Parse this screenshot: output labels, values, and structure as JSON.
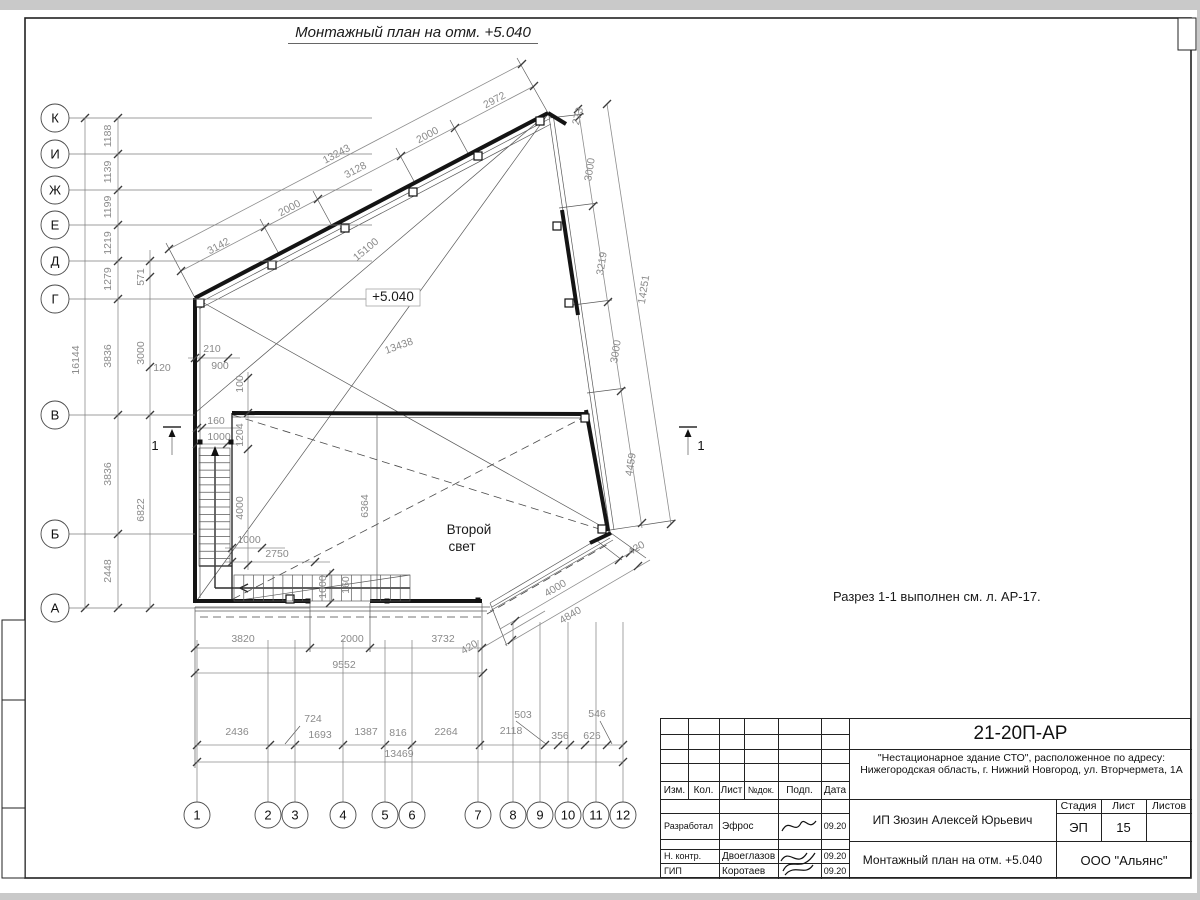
{
  "title": "Монтажный план на отм. +5.040",
  "note": "Разрез 1-1 выполнен см. л. АР-17.",
  "second_light": {
    "line1": "Второй",
    "line2": "свет"
  },
  "elevation_mark": "+5.040",
  "stamp": {
    "code": "21-20П-АР",
    "address1": "\"Нестационарное здание СТО\", расположенное по адресу:",
    "address2": "Нижегородская область, г. Нижний Новгород, ул. Вторчермета, 1А",
    "client": "ИП Зюзин Алексей Юрьевич",
    "doc_title": "Монтажный план на отм. +5.040",
    "org": "ООО \"Альянс\"",
    "cols": [
      "Изм.",
      "Кол.",
      "Лист",
      "№док.",
      "Подп.",
      "Дата"
    ],
    "stage_label": "Стадия",
    "sheet_label": "Лист",
    "sheets_label": "Листов",
    "stage": "ЭП",
    "sheet_num": "15",
    "rows": [
      {
        "role": "Разработал",
        "name": "Эфрос",
        "date": "09.20"
      },
      {
        "role": "Н. контр.",
        "name": "Двоеглазов",
        "date": "09.20"
      },
      {
        "role": "ГИП",
        "name": "Коротаев",
        "date": "09.20"
      }
    ]
  },
  "drawing": {
    "axis_left": {
      "cx": 55,
      "r": 14,
      "items": [
        {
          "label": "К",
          "y": 118,
          "x2": 372
        },
        {
          "label": "И",
          "y": 154,
          "x2": 372
        },
        {
          "label": "Ж",
          "y": 190,
          "x2": 372
        },
        {
          "label": "Е",
          "y": 225,
          "x2": 372
        },
        {
          "label": "Д",
          "y": 261,
          "x2": 372
        },
        {
          "label": "Г",
          "y": 299,
          "x2": 372
        },
        {
          "label": "В",
          "y": 415,
          "x2": 195
        },
        {
          "label": "Б",
          "y": 534,
          "x2": 195
        },
        {
          "label": "А",
          "y": 608,
          "x2": 310
        }
      ]
    },
    "axis_bottom": {
      "cy": 815,
      "r": 13,
      "items": [
        {
          "label": "1",
          "x": 197,
          "ly": 640
        },
        {
          "label": "2",
          "x": 268,
          "ly": 640
        },
        {
          "label": "3",
          "x": 295,
          "ly": 640
        },
        {
          "label": "4",
          "x": 343,
          "ly": 640
        },
        {
          "label": "5",
          "x": 385,
          "ly": 640
        },
        {
          "label": "6",
          "x": 412,
          "ly": 640
        },
        {
          "label": "7",
          "x": 478,
          "ly": 640
        },
        {
          "label": "8",
          "x": 513,
          "ly": 622
        },
        {
          "label": "9",
          "x": 540,
          "ly": 622
        },
        {
          "label": "10",
          "x": 568,
          "ly": 622
        },
        {
          "label": "11",
          "x": 596,
          "ly": 622
        },
        {
          "label": "12",
          "x": 623,
          "ly": 622
        }
      ]
    },
    "wall_lines": [
      [
        195,
        298,
        548,
        113
      ],
      [
        195,
        298,
        195,
        603
      ],
      [
        232,
        413,
        588,
        414
      ],
      [
        195,
        601,
        310,
        601
      ],
      [
        370,
        601,
        482,
        601
      ],
      [
        562,
        210,
        578,
        315
      ],
      [
        586,
        410,
        608,
        531
      ],
      [
        590,
        543,
        611,
        533
      ],
      [
        548,
        113,
        566,
        124
      ]
    ],
    "med_lines": [
      [
        232,
        413,
        232,
        600
      ],
      [
        199,
        566,
        232,
        566
      ],
      [
        215,
        588,
        215,
        452
      ],
      [
        410,
        588,
        215,
        588
      ],
      [
        248,
        584,
        240,
        588
      ],
      [
        240,
        588,
        248,
        592
      ]
    ],
    "thin_lines": [
      [
        197,
        304,
        549,
        119
      ],
      [
        199,
        309,
        551,
        124
      ],
      [
        549,
        116,
        610,
        532
      ],
      [
        553,
        114,
        614,
        530
      ],
      [
        608,
        533,
        490,
        603
      ],
      [
        610,
        538,
        492,
        607
      ],
      [
        195,
        607,
        490,
        607
      ],
      [
        195,
        611,
        487,
        611
      ],
      [
        490,
        611,
        613,
        540
      ],
      [
        232,
        417,
        588,
        418
      ],
      [
        200,
        303,
        200,
        598
      ],
      [
        195,
        603,
        548,
        114
      ],
      [
        195,
        413,
        548,
        113
      ],
      [
        195,
        298,
        610,
        531
      ],
      [
        377,
        413,
        377,
        601
      ],
      [
        234,
        601,
        410,
        575
      ],
      [
        195,
        298,
        166,
        243
      ],
      [
        279,
        254,
        260,
        219
      ],
      [
        332,
        226,
        313,
        191
      ],
      [
        415,
        183,
        396,
        148
      ],
      [
        469,
        155,
        450,
        120
      ],
      [
        548,
        113,
        517,
        58
      ],
      [
        549,
        118,
        584,
        114
      ],
      [
        559,
        208,
        598,
        203
      ],
      [
        573,
        305,
        612,
        300
      ],
      [
        587,
        393,
        626,
        388
      ],
      [
        610,
        530,
        676,
        520
      ],
      [
        608,
        531,
        646,
        558
      ],
      [
        490,
        603,
        507,
        646
      ],
      [
        596,
        540,
        622,
        560
      ],
      [
        195,
        607,
        195,
        768
      ],
      [
        310,
        603,
        310,
        652
      ],
      [
        370,
        603,
        370,
        652
      ],
      [
        482,
        603,
        482,
        750
      ],
      [
        516,
        721,
        546,
        744
      ],
      [
        600,
        721,
        612,
        744
      ],
      [
        300,
        726,
        285,
        744
      ]
    ],
    "dash_lines": [
      [
        233,
        415,
        606,
        531
      ],
      [
        233,
        599,
        588,
        415
      ],
      [
        200,
        617,
        482,
        617
      ],
      [
        487,
        614,
        610,
        543
      ]
    ],
    "dim_lines": [
      [
        85,
        118,
        85,
        608
      ],
      [
        118,
        118,
        118,
        608
      ],
      [
        150,
        250,
        150,
        608
      ],
      [
        188,
        358,
        240,
        358
      ],
      [
        197,
        428,
        240,
        428
      ],
      [
        197,
        444,
        240,
        444
      ],
      [
        225,
        548,
        285,
        548
      ],
      [
        225,
        562,
        330,
        562
      ],
      [
        248,
        372,
        248,
        570
      ],
      [
        330,
        570,
        330,
        604
      ],
      [
        181,
        271,
        534,
        86
      ],
      [
        169,
        249,
        522,
        64
      ],
      [
        578,
        108,
        642,
        528
      ],
      [
        607,
        104,
        671,
        524
      ],
      [
        640,
        547,
        500,
        629
      ],
      [
        650,
        560,
        505,
        645
      ],
      [
        195,
        648,
        482,
        648
      ],
      [
        482,
        648,
        545,
        611
      ],
      [
        195,
        673,
        483,
        673
      ],
      [
        197,
        745,
        623,
        745
      ],
      [
        197,
        762,
        623,
        762
      ]
    ],
    "ticks": [
      [
        85,
        118
      ],
      [
        85,
        608
      ],
      [
        118,
        118
      ],
      [
        118,
        154
      ],
      [
        118,
        190
      ],
      [
        118,
        225
      ],
      [
        118,
        261
      ],
      [
        118,
        299
      ],
      [
        118,
        415
      ],
      [
        118,
        534
      ],
      [
        118,
        608
      ],
      [
        150,
        261
      ],
      [
        150,
        277
      ],
      [
        150,
        367
      ],
      [
        150,
        415
      ],
      [
        150,
        608
      ],
      [
        195,
        358
      ],
      [
        201,
        358
      ],
      [
        228,
        358
      ],
      [
        197,
        428
      ],
      [
        202,
        428
      ],
      [
        197,
        444
      ],
      [
        227,
        444
      ],
      [
        232,
        548
      ],
      [
        262,
        548
      ],
      [
        232,
        562
      ],
      [
        315,
        562
      ],
      [
        248,
        378
      ],
      [
        248,
        413
      ],
      [
        248,
        449
      ],
      [
        248,
        565
      ],
      [
        330,
        573
      ],
      [
        330,
        603
      ],
      [
        181,
        271
      ],
      [
        265,
        227
      ],
      [
        318,
        199
      ],
      [
        401,
        156
      ],
      [
        455,
        128
      ],
      [
        534,
        86
      ],
      [
        169,
        249
      ],
      [
        522,
        64
      ],
      [
        578,
        109
      ],
      [
        579,
        117
      ],
      [
        593,
        206
      ],
      [
        608,
        302
      ],
      [
        621,
        391
      ],
      [
        642,
        523
      ],
      [
        607,
        104
      ],
      [
        671,
        524
      ],
      [
        630,
        553
      ],
      [
        619,
        560
      ],
      [
        515,
        621
      ],
      [
        638,
        566
      ],
      [
        512,
        640
      ],
      [
        195,
        648
      ],
      [
        310,
        648
      ],
      [
        370,
        648
      ],
      [
        482,
        648
      ],
      [
        195,
        673
      ],
      [
        483,
        673
      ],
      [
        197,
        745
      ],
      [
        270,
        745
      ],
      [
        295,
        745
      ],
      [
        343,
        745
      ],
      [
        385,
        745
      ],
      [
        412,
        745
      ],
      [
        480,
        745
      ],
      [
        545,
        745
      ],
      [
        558,
        745
      ],
      [
        570,
        745
      ],
      [
        585,
        745
      ],
      [
        607,
        745
      ],
      [
        623,
        745
      ],
      [
        197,
        762
      ],
      [
        623,
        762
      ]
    ],
    "squares": [
      [
        200,
        303
      ],
      [
        272,
        265
      ],
      [
        345,
        228
      ],
      [
        413,
        192
      ],
      [
        478,
        156
      ],
      [
        540,
        121
      ],
      [
        557,
        226
      ],
      [
        569,
        303
      ],
      [
        585,
        418
      ],
      [
        602,
        529
      ],
      [
        290,
        599
      ]
    ],
    "dots": [
      [
        308,
        601
      ],
      [
        387,
        601
      ],
      [
        478,
        600
      ],
      [
        200,
        442
      ],
      [
        231,
        442
      ]
    ],
    "steps": [
      {
        "x": 199,
        "y": 448,
        "w": 31,
        "h": 118,
        "n": 16,
        "dir": "h"
      },
      {
        "x": 234,
        "y": 575,
        "w": 176,
        "h": 26,
        "n": 18,
        "dir": "v"
      }
    ],
    "walk_arrow": {
      "x": 215,
      "y": 452
    },
    "elev_box": {
      "x": 366,
      "y": 289,
      "w": 54,
      "h": 17,
      "tx": 393,
      "ty": 301
    },
    "section_marks": [
      {
        "num": "1",
        "bx1": 163,
        "bx2": 181,
        "by": 427,
        "sx": 172,
        "sy1": 455,
        "sy2": 431,
        "tx": 155,
        "ty": 450
      },
      {
        "num": "1",
        "bx1": 679,
        "bx2": 697,
        "by": 427,
        "sx": 688,
        "sy1": 455,
        "sy2": 431,
        "tx": 701,
        "ty": 450
      }
    ],
    "labels": [
      {
        "t": "16144",
        "x": 79,
        "y": 360,
        "r": -90
      },
      {
        "t": "1188",
        "x": 111,
        "y": 136,
        "r": -90
      },
      {
        "t": "1139",
        "x": 111,
        "y": 172,
        "r": -90
      },
      {
        "t": "1199",
        "x": 111,
        "y": 207,
        "r": -90
      },
      {
        "t": "1219",
        "x": 111,
        "y": 243,
        "r": -90
      },
      {
        "t": "1279",
        "x": 111,
        "y": 279,
        "r": -90
      },
      {
        "t": "3836",
        "x": 111,
        "y": 356,
        "r": -90
      },
      {
        "t": "3836",
        "x": 111,
        "y": 474,
        "r": -90
      },
      {
        "t": "2448",
        "x": 111,
        "y": 571,
        "r": -90
      },
      {
        "t": "571",
        "x": 144,
        "y": 277,
        "r": -90
      },
      {
        "t": "3000",
        "x": 144,
        "y": 353,
        "r": -90
      },
      {
        "t": "6822",
        "x": 144,
        "y": 510,
        "r": -90
      },
      {
        "t": "120",
        "x": 162,
        "y": 371,
        "r": 0
      },
      {
        "t": "210",
        "x": 212,
        "y": 352,
        "r": 0
      },
      {
        "t": "900",
        "x": 220,
        "y": 369,
        "r": 0
      },
      {
        "t": "100",
        "x": 243,
        "y": 384,
        "r": -90
      },
      {
        "t": "160",
        "x": 216,
        "y": 424,
        "r": 0
      },
      {
        "t": "1000",
        "x": 219,
        "y": 440,
        "r": 0
      },
      {
        "t": "1204",
        "x": 243,
        "y": 435,
        "r": -90
      },
      {
        "t": "4000",
        "x": 243,
        "y": 508,
        "r": -90
      },
      {
        "t": "1000",
        "x": 249,
        "y": 543,
        "r": 0
      },
      {
        "t": "2750",
        "x": 277,
        "y": 557,
        "r": 0
      },
      {
        "t": "1000",
        "x": 326,
        "y": 587,
        "r": -90
      },
      {
        "t": "160",
        "x": 349,
        "y": 585,
        "r": -90
      },
      {
        "t": "6364",
        "x": 368,
        "y": 506,
        "r": -90
      },
      {
        "t": "13438",
        "x": 400,
        "y": 349,
        "r": -20
      },
      {
        "t": "15100",
        "x": 368,
        "y": 252,
        "r": -40
      },
      {
        "t": "13243",
        "x": 338,
        "y": 157,
        "r": -28
      },
      {
        "t": "3142",
        "x": 220,
        "y": 249,
        "r": -28
      },
      {
        "t": "2000",
        "x": 291,
        "y": 211,
        "r": -28
      },
      {
        "t": "3128",
        "x": 357,
        "y": 173,
        "r": -28
      },
      {
        "t": "2000",
        "x": 429,
        "y": 138,
        "r": -28
      },
      {
        "t": "2972",
        "x": 496,
        "y": 103,
        "r": -28
      },
      {
        "t": "273",
        "x": 581,
        "y": 117,
        "r": -75
      },
      {
        "t": "3000",
        "x": 593,
        "y": 170,
        "r": -81
      },
      {
        "t": "3219",
        "x": 605,
        "y": 264,
        "r": -81
      },
      {
        "t": "3000",
        "x": 619,
        "y": 352,
        "r": -81
      },
      {
        "t": "4459",
        "x": 634,
        "y": 465,
        "r": -81
      },
      {
        "t": "14251",
        "x": 647,
        "y": 290,
        "r": -81
      },
      {
        "t": "420",
        "x": 638,
        "y": 551,
        "r": -31
      },
      {
        "t": "4000",
        "x": 557,
        "y": 591,
        "r": -31
      },
      {
        "t": "4840",
        "x": 572,
        "y": 618,
        "r": -31
      },
      {
        "t": "3820",
        "x": 243,
        "y": 642,
        "r": 0
      },
      {
        "t": "2000",
        "x": 352,
        "y": 642,
        "r": 0
      },
      {
        "t": "3732",
        "x": 443,
        "y": 642,
        "r": 0
      },
      {
        "t": "420",
        "x": 471,
        "y": 650,
        "r": -31
      },
      {
        "t": "9552",
        "x": 344,
        "y": 668,
        "r": 0
      },
      {
        "t": "2436",
        "x": 237,
        "y": 735,
        "r": 0
      },
      {
        "t": "724",
        "x": 313,
        "y": 722,
        "r": 0
      },
      {
        "t": "1693",
        "x": 320,
        "y": 738,
        "r": 0
      },
      {
        "t": "1387",
        "x": 366,
        "y": 735,
        "r": 0
      },
      {
        "t": "816",
        "x": 398,
        "y": 736,
        "r": 0
      },
      {
        "t": "2264",
        "x": 446,
        "y": 735,
        "r": 0
      },
      {
        "t": "2118",
        "x": 511,
        "y": 734,
        "r": 0
      },
      {
        "t": "503",
        "x": 523,
        "y": 718,
        "r": 0
      },
      {
        "t": "356",
        "x": 560,
        "y": 739,
        "r": 0
      },
      {
        "t": "626",
        "x": 592,
        "y": 739,
        "r": 0
      },
      {
        "t": "546",
        "x": 597,
        "y": 717,
        "r": 0
      },
      {
        "t": "13469",
        "x": 399,
        "y": 757,
        "r": 0
      },
      {
        "t": "Второй",
        "x": 469,
        "y": 534,
        "r": 0,
        "c": "big"
      },
      {
        "t": "свет",
        "x": 462,
        "y": 551,
        "r": 0,
        "c": "big"
      }
    ]
  }
}
